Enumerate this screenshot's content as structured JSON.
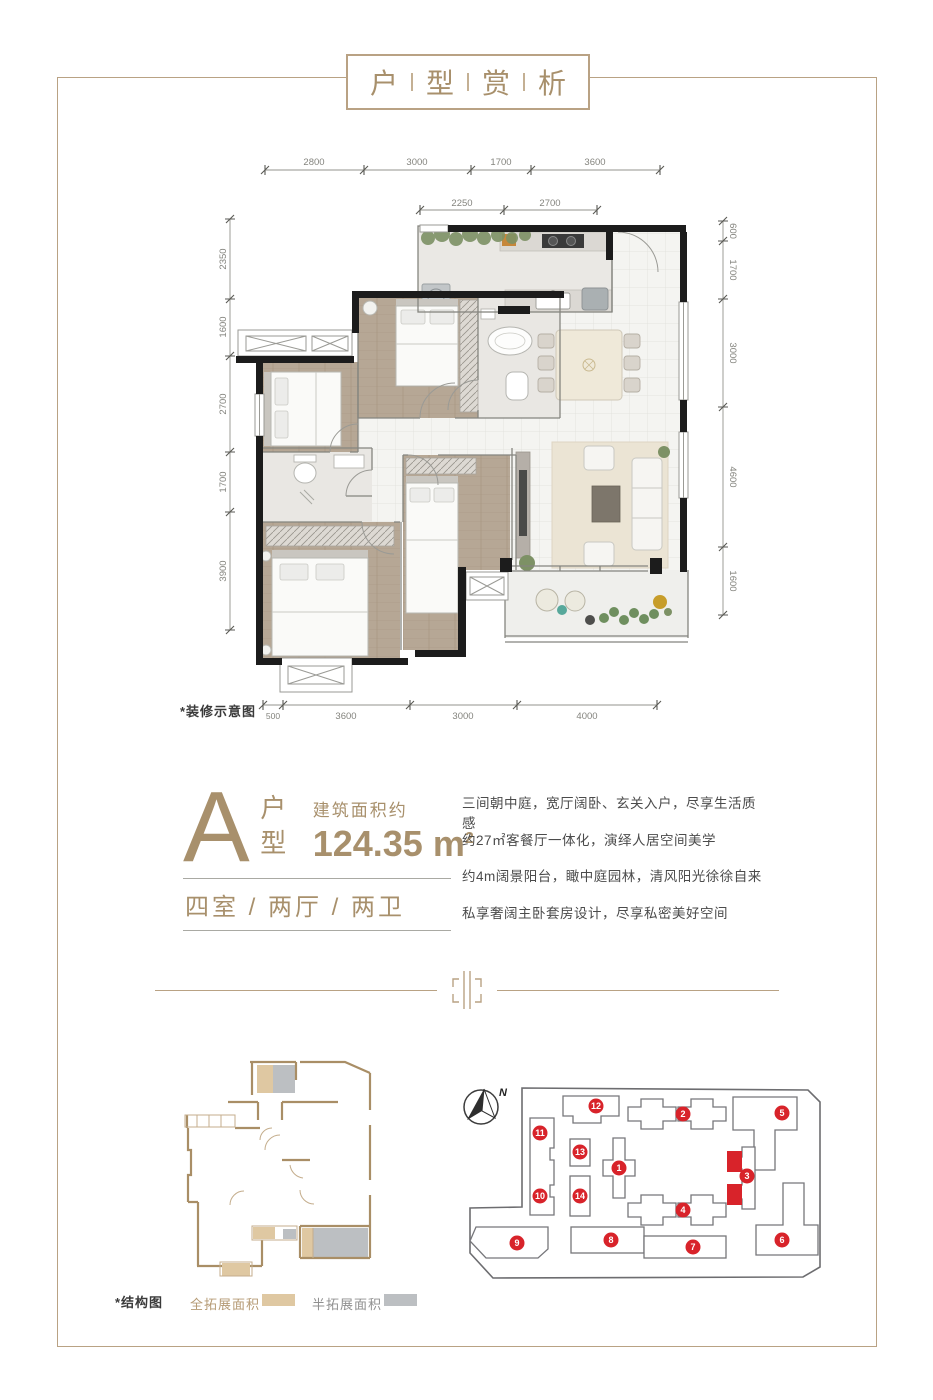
{
  "header": {
    "title_parts": [
      "户",
      "型",
      "赏",
      "析"
    ]
  },
  "unit": {
    "letter": "A",
    "type_label": "户型",
    "area_prefix": "建筑面积约",
    "area_value": "124.35",
    "area_unit_base": "m",
    "area_unit_sup": "2",
    "layout": "四室 / 两厅 / 两卫"
  },
  "description": {
    "lines": [
      "三间朝中庭，宽厅阔卧、玄关入户，尽享生活质感",
      "约27㎡客餐厅一体化，演绎人居空间美学",
      "约4m阔景阳台，瞰中庭园林，清风阳光徐徐自来",
      "私享奢阔主卧套房设计，尽享私密美好空间"
    ]
  },
  "floorplan": {
    "note": "*装修示意图",
    "dims_top": [
      "2800",
      "3000",
      "1700",
      "3600"
    ],
    "dims_top_inner": [
      "2250",
      "2700"
    ],
    "dims_left": [
      "2350",
      "1600",
      "2700",
      "1700",
      "3900"
    ],
    "dims_right": [
      "600",
      "1700",
      "3000",
      "4600",
      "1600"
    ],
    "dims_bottom": [
      "500",
      "3600",
      "3000",
      "4000"
    ]
  },
  "structure": {
    "note": "*结构图",
    "legend": [
      {
        "label": "全拓展面积",
        "color": "#dfc8a2"
      },
      {
        "label": "半拓展面积",
        "color": "#bcbfc2"
      }
    ]
  },
  "site_plan": {
    "compass_label": "N",
    "buildings": [
      "1",
      "2",
      "3",
      "4",
      "5",
      "6",
      "7",
      "8",
      "9",
      "10",
      "11",
      "12",
      "13",
      "14"
    ],
    "highlighted_building": "3",
    "badge_color": "#d8232a"
  },
  "colors": {
    "accent_gold": "#a8906c",
    "frame_gold": "#b9a284",
    "text_dark": "#4b4b4b",
    "wall_black": "#1c1c1c",
    "badge_red": "#d8232a"
  }
}
